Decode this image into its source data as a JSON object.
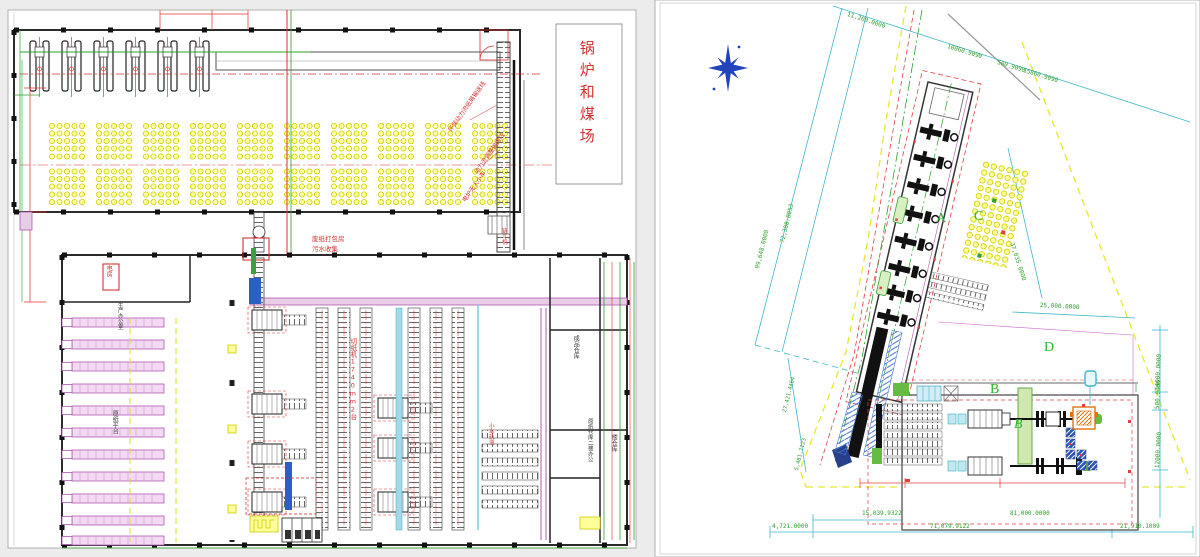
{
  "colors": {
    "annotation_red": "#d43030",
    "dimension_green": "#2ca02c",
    "dimension_cyan": "#3fb8c9",
    "coal_yellow": "#ffff99",
    "boundary_yellow": "#e8e830",
    "machine_magenta": "#b05ab0",
    "pipe_blue": "#2d55b8",
    "equipment_orange": "#e0720f",
    "compass_blue": "#2244bb"
  },
  "left_sheet": {
    "labels": {
      "boiler_coal_yard": "锅炉和煤场",
      "env_conveyor": "环保动力流纸屑输送线",
      "power_conveyor": "动力流调整输送线",
      "furnace_cart": "电炉无人小车",
      "chain_bucket": "链斗机",
      "baling_room": "废纸打包房",
      "sewage_collect": "污水收集",
      "electric_room": "电房",
      "production_office": "生产办公室",
      "paper_platform": "原纸平台",
      "paper_cutter": "切纸机1740mm2台",
      "cart_track": "小车轨道",
      "finished_warehouse": "成品仓库",
      "second_floor_office": "原纸仓库二楼办公",
      "first_floor_warehouse": "一楼仓库"
    }
  },
  "right_sheet": {
    "area_letters": {
      "a": "A",
      "b": "B",
      "b_italic": "B",
      "c": "C",
      "d": "D"
    },
    "dims": {
      "top_left": "11,200.0000",
      "top_1": "10060.9090",
      "top_2": "500.9090",
      "top_3": "15860.9090",
      "left_outer": "99,648.0008",
      "left_inner": "72,388.8053",
      "left_lower": "27,421.4464",
      "left_bottom": "5,481.7123",
      "c_side": "37,035.0000",
      "mid_right": "25,000.0000",
      "right_1": "14000.0000",
      "right_2": "500.0000",
      "right_3": "12000.0000",
      "bottom_r1a": "15,039.9322",
      "bottom_r1b": "81,000.0000",
      "bottom_r2a": "4,721.0000",
      "bottom_r2b": "71,079.9122",
      "bottom_r2c": "21,910.1009"
    }
  }
}
